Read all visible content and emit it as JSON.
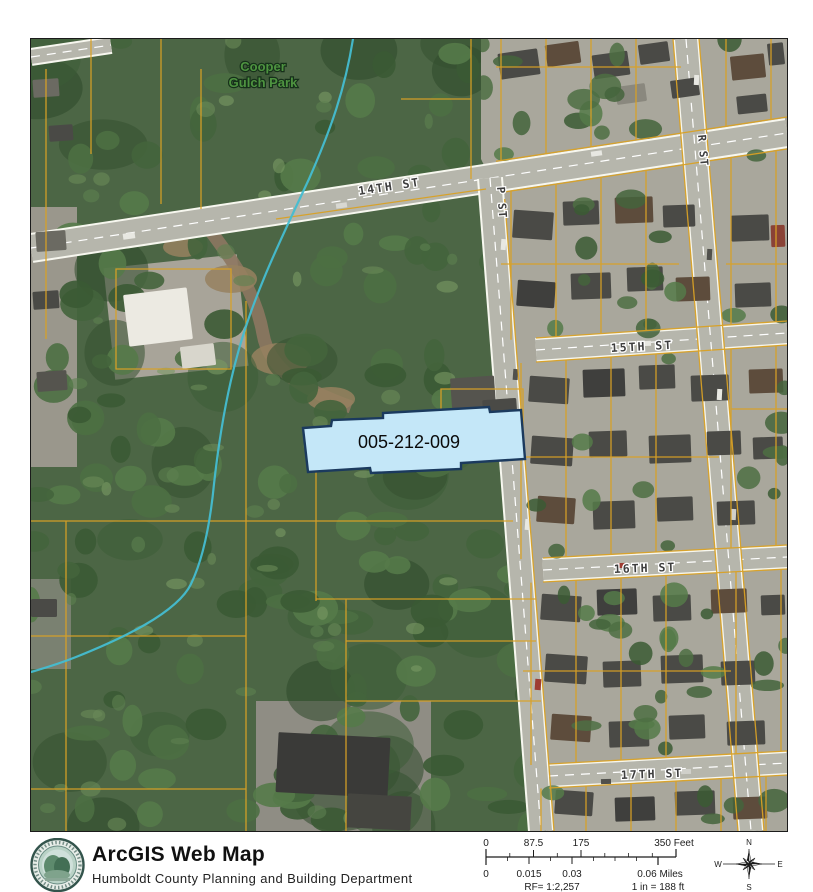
{
  "map": {
    "park_label": {
      "line1": "Cooper",
      "line2": "Gulch Park"
    },
    "streets": [
      {
        "id": "14th",
        "label": "14TH ST"
      },
      {
        "id": "15th",
        "label": "15TH ST"
      },
      {
        "id": "16th",
        "label": "16TH ST"
      },
      {
        "id": "17th",
        "label": "17TH ST"
      },
      {
        "id": "p",
        "label": "P ST"
      },
      {
        "id": "r",
        "label": "R ST"
      }
    ],
    "highlight_parcel": {
      "apn": "005-212-009",
      "fill": "#c4e7f8",
      "border": "#1b3a5e"
    },
    "colors": {
      "forest": "#4c6645",
      "residential_ground": "#a9a79c",
      "street": "#b6b6ac",
      "street_edge": "#f7f7ef",
      "parcel_line": "#d9a125",
      "stream": "#44bdd1"
    }
  },
  "footer": {
    "title": "ArcGIS Web Map",
    "subtitle": "Humboldt County Planning and Building Department",
    "logo": "humboldt-county-seal"
  },
  "scalebar": {
    "feet_ticks": [
      "0",
      "87.5",
      "175"
    ],
    "feet_max": "350 Feet",
    "miles_ticks": [
      "0",
      "0.015",
      "0.03"
    ],
    "miles_max": "0.06 Miles",
    "rf": "RF= 1:2,257",
    "inches": "1 in = 188 ft"
  },
  "compass": {
    "n": "N",
    "s": "S",
    "e": "E",
    "w": "W"
  }
}
